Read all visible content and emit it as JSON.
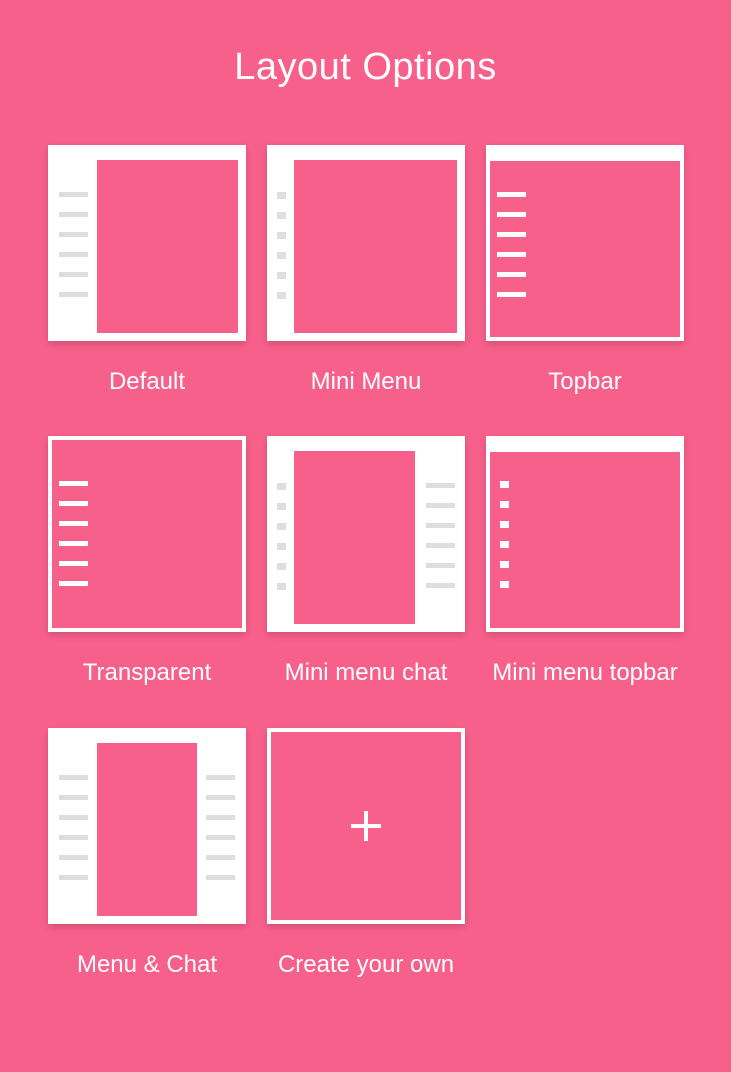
{
  "page": {
    "title": "Layout Options"
  },
  "colors": {
    "background_pink": "#F8608C",
    "card_white": "#FFFFFF",
    "menu_line_gray": "#DEDEDE"
  },
  "layouts": [
    {
      "label": "Default",
      "variant": "default",
      "menu_item_count": 6
    },
    {
      "label": "Mini Menu",
      "variant": "mini-menu",
      "menu_item_count": 6
    },
    {
      "label": "Topbar",
      "variant": "topbar",
      "menu_item_count": 6
    },
    {
      "label": "Transparent",
      "variant": "transparent",
      "menu_item_count": 6
    },
    {
      "label": "Mini menu chat",
      "variant": "mini-menu-chat",
      "menu_item_count": 6,
      "chat_line_count": 6
    },
    {
      "label": "Mini menu topbar",
      "variant": "mini-menu-topbar",
      "menu_item_count": 6
    },
    {
      "label": "Menu & Chat",
      "variant": "menu-chat",
      "menu_item_count": 6,
      "chat_line_count": 6
    },
    {
      "label": "Create your own",
      "variant": "create-your-own",
      "icon": "plus"
    }
  ]
}
